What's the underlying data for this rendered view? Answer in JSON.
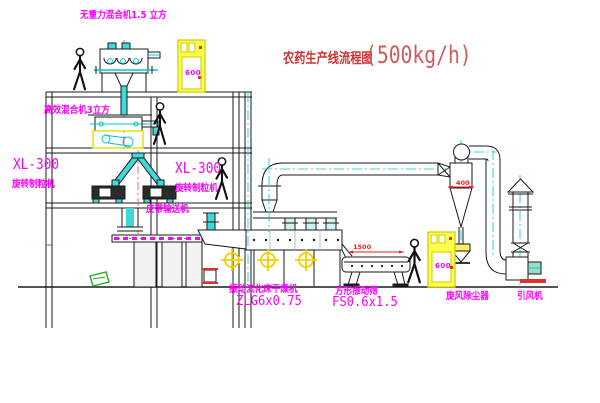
{
  "title": {
    "name": "农药生产线流程图",
    "capacity": "(500kg/h)"
  },
  "labels": {
    "top_mixer": "无重力混合机1.5 立方",
    "mid_mixer": "高效混合机3立方",
    "granulator_left_model": "XL-300",
    "granulator_left_name": "旋转制粒机",
    "granulator_mid_model": "XL-300",
    "granulator_mid_name": "旋转制粒机",
    "belt_conveyor": "皮带输送机",
    "dryer_name": "振动流化床干燥机",
    "dryer_model": "ZLG6x0.75",
    "screen_name": "方形振动筛",
    "screen_model": "FS0.6x1.5",
    "cyclone": "旋风除尘器",
    "fan": "引风机"
  },
  "dimensions": {
    "cyclone_outlet": "400",
    "screen_length": "1500"
  },
  "cabinets": {
    "top_text": "600",
    "right_text": "600"
  },
  "colors": {
    "line_black": "#1a1a1a",
    "cad_cyan": "#00c8c8",
    "cyan_fill": "#3fd9d9",
    "label_magenta": "#ff00ff",
    "title_red": "#cc3434",
    "dimension_red": "#ff1a1a",
    "cabinet_yellow": "#ffff4d",
    "motor_yellow": "#f0d000",
    "base_red": "#e03030",
    "pallet_green": "#1faf1f"
  }
}
